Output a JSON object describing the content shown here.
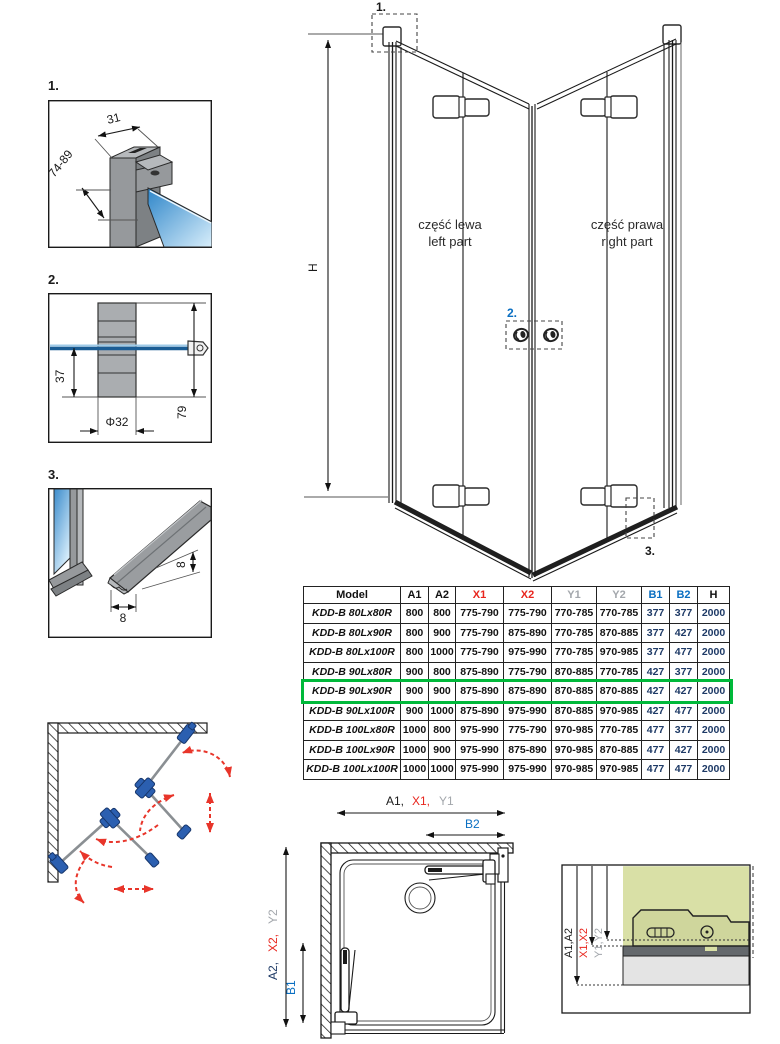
{
  "details": {
    "d1": {
      "label": "1.",
      "dim_width": "31",
      "dim_range": "74-89"
    },
    "d2": {
      "label": "2.",
      "dim_offset": "37",
      "dim_diameter": "Φ32",
      "dim_height": "79"
    },
    "d3": {
      "label": "3.",
      "dim_height": "8",
      "dim_width": "8"
    }
  },
  "main_drawing": {
    "height_label": "H",
    "callout_1": "1.",
    "callout_2": "2.",
    "callout_3": "3.",
    "left_part_line1": "część lewa",
    "left_part_line2": "left part",
    "right_part_line1": "część prawa",
    "right_part_line2": "right part"
  },
  "table": {
    "headers": [
      "Model",
      "A1",
      "A2",
      "X1",
      "X2",
      "Y1",
      "Y2",
      "B1",
      "B2",
      "H"
    ],
    "rows": [
      {
        "model": "KDD-B 80Lx80R",
        "values": [
          "800",
          "800",
          "775-790",
          "775-790",
          "770-785",
          "770-785",
          "377",
          "377",
          "2000"
        ]
      },
      {
        "model": "KDD-B 80Lx90R",
        "values": [
          "800",
          "900",
          "775-790",
          "875-890",
          "770-785",
          "870-885",
          "377",
          "427",
          "2000"
        ]
      },
      {
        "model": "KDD-B 80Lx100R",
        "values": [
          "800",
          "1000",
          "775-790",
          "975-990",
          "770-785",
          "970-985",
          "377",
          "477",
          "2000"
        ]
      },
      {
        "model": "KDD-B 90Lx80R",
        "values": [
          "900",
          "800",
          "875-890",
          "775-790",
          "870-885",
          "770-785",
          "427",
          "377",
          "2000"
        ]
      },
      {
        "model": "KDD-B 90Lx90R",
        "values": [
          "900",
          "900",
          "875-890",
          "875-890",
          "870-885",
          "870-885",
          "427",
          "427",
          "2000"
        ]
      },
      {
        "model": "KDD-B 90Lx100R",
        "values": [
          "900",
          "1000",
          "875-890",
          "975-990",
          "870-885",
          "970-985",
          "427",
          "477",
          "2000"
        ]
      },
      {
        "model": "KDD-B 100Lx80R",
        "values": [
          "1000",
          "800",
          "975-990",
          "775-790",
          "970-985",
          "770-785",
          "477",
          "377",
          "2000"
        ]
      },
      {
        "model": "KDD-B 100Lx90R",
        "values": [
          "1000",
          "900",
          "975-990",
          "875-890",
          "970-985",
          "870-885",
          "477",
          "427",
          "2000"
        ]
      },
      {
        "model": "KDD-B 100Lx100R",
        "values": [
          "1000",
          "1000",
          "975-990",
          "975-990",
          "970-985",
          "970-985",
          "477",
          "477",
          "2000"
        ]
      }
    ],
    "highlighted_model": "KDD-B 90Lx90R"
  },
  "plan_view": {
    "top_dim_a1": "A1,",
    "top_dim_x1": "X1,",
    "top_dim_y1": "Y1",
    "dim_b2": "B2",
    "left_dim_a2": "A2,",
    "left_dim_x2": "X2,",
    "left_dim_y2": "Y2",
    "dim_b1": "B1"
  },
  "wall_detail": {
    "dim_a": "A1,A2",
    "dim_x": "X1,X2",
    "dim_y": "Y1,Y2"
  },
  "colors": {
    "red": "#e8251d",
    "blue": "#0a6fc2",
    "gray": "#a3a7ac",
    "navy": "#1e3a66",
    "highlight_green": "#00b93a",
    "glass_blue": "#3b8ccc",
    "panel_green": "#d9e0a6"
  }
}
